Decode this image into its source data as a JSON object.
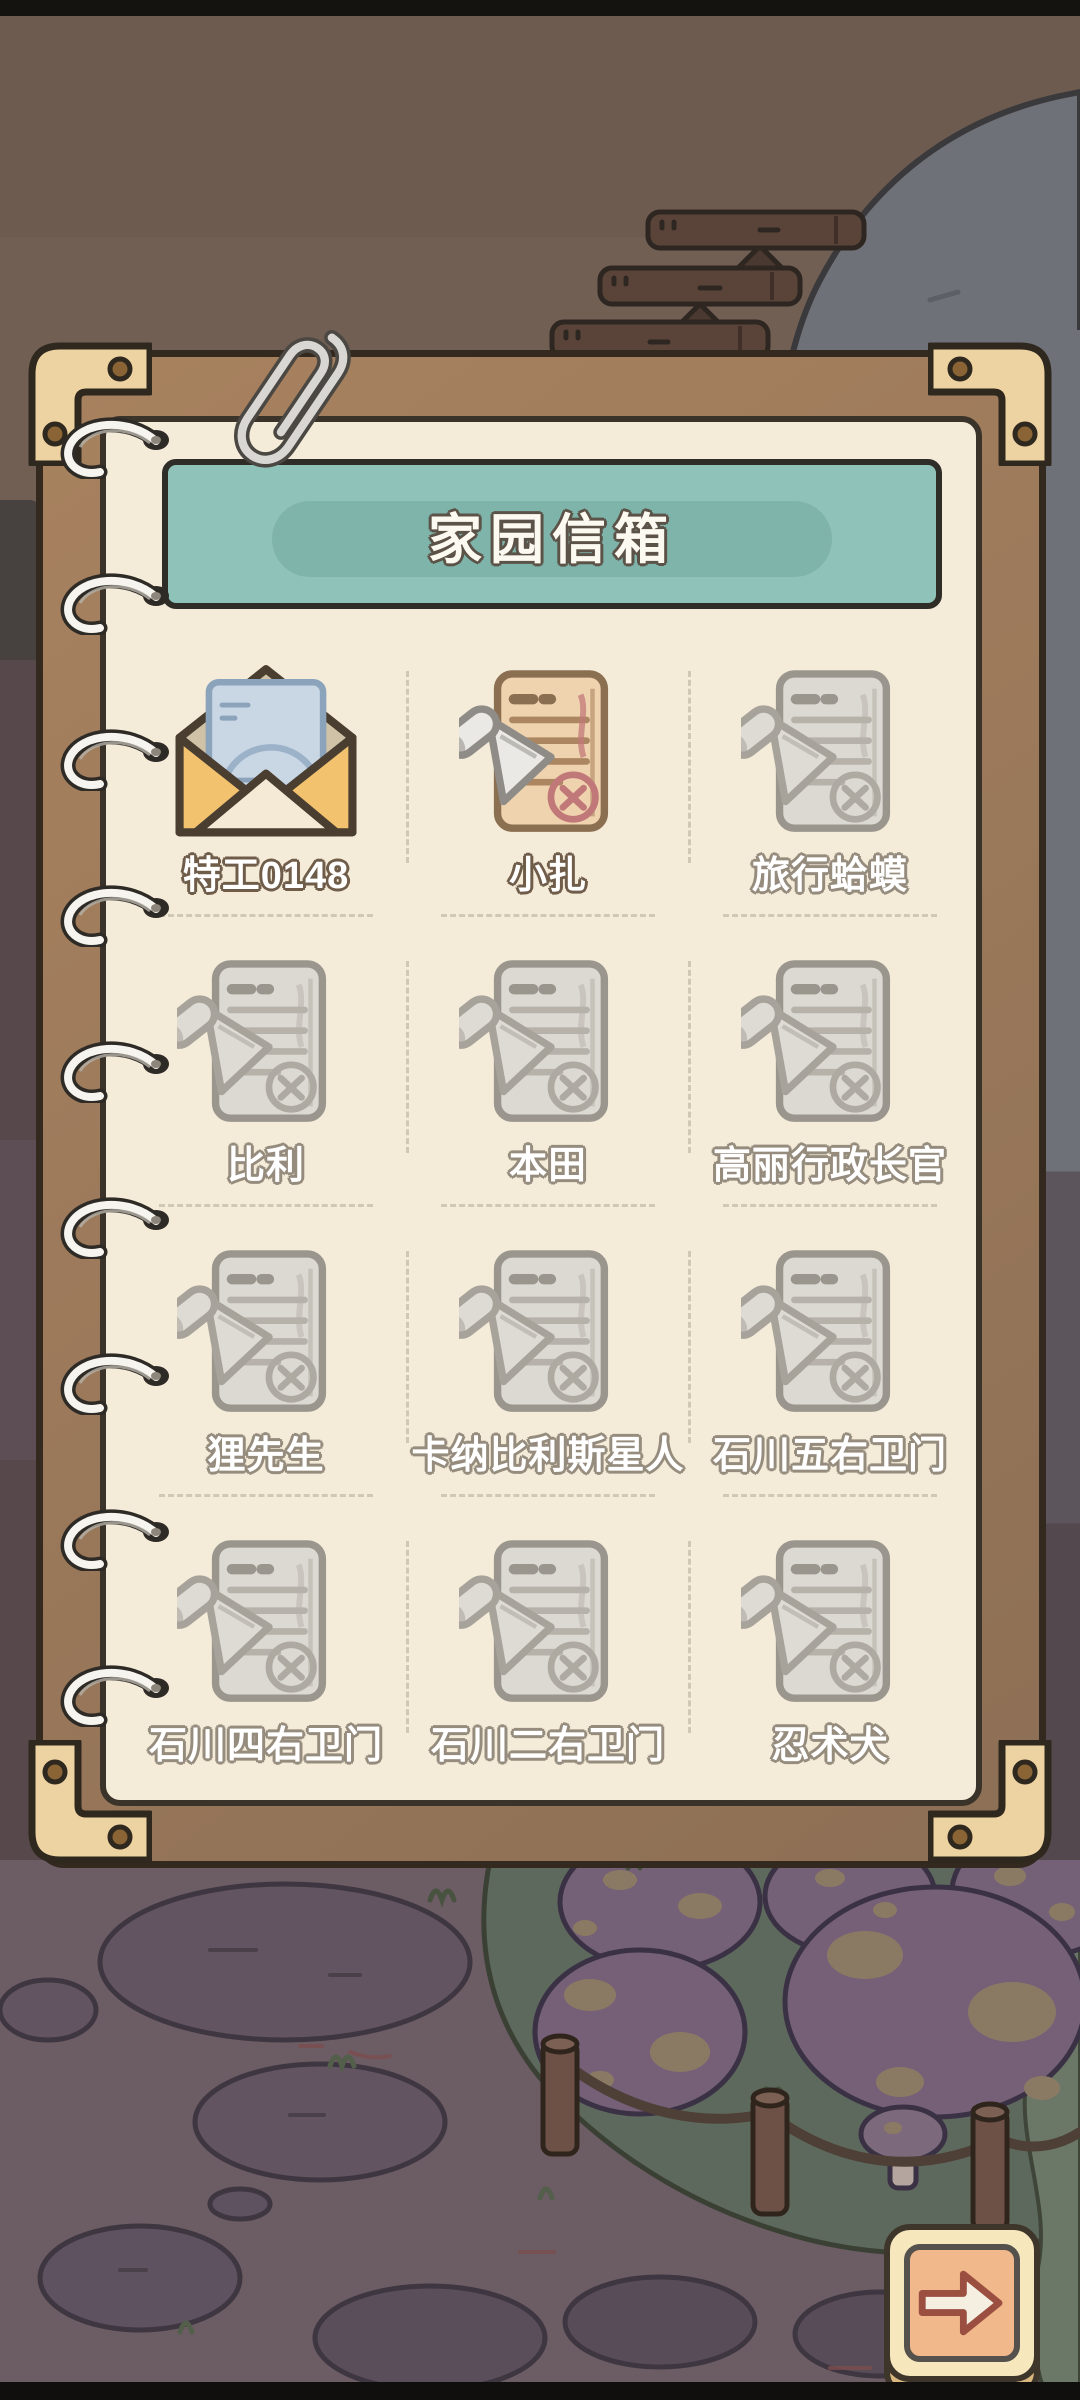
{
  "header": {
    "title": "家园信箱"
  },
  "mailbox": {
    "items": [
      {
        "label": "特工0148",
        "icon": "open-envelope-icon",
        "state": "opened"
      },
      {
        "label": "小扎",
        "icon": "unread-letter-icon",
        "state": "new"
      },
      {
        "label": "旅行蛤蟆",
        "icon": "read-letter-icon",
        "state": "read"
      },
      {
        "label": "比利",
        "icon": "read-letter-icon",
        "state": "read"
      },
      {
        "label": "本田",
        "icon": "read-letter-icon",
        "state": "read"
      },
      {
        "label": "高丽行政长官",
        "icon": "read-letter-icon",
        "state": "read"
      },
      {
        "label": "狸先生",
        "icon": "read-letter-icon",
        "state": "read"
      },
      {
        "label": "卡纳比利斯星人",
        "icon": "read-letter-icon",
        "state": "read"
      },
      {
        "label": "石川五右卫门",
        "icon": "read-letter-icon",
        "state": "read"
      },
      {
        "label": "石川四右卫门",
        "icon": "read-letter-icon",
        "state": "read"
      },
      {
        "label": "石川二右卫门",
        "icon": "read-letter-icon",
        "state": "read"
      },
      {
        "label": "忍术犬",
        "icon": "read-letter-icon",
        "state": "read"
      }
    ]
  },
  "pagination": {
    "next_button": "next-page-arrow"
  },
  "colors": {
    "banner_teal": "#8fc2b9",
    "paper_cream": "#f4ecd9",
    "frame_wood": "#9d7a5e",
    "corner_brass": "#eed3a2",
    "button_face": "#f6e8bc",
    "button_inner": "#f1b88b",
    "arrow_outline": "#9b4f40"
  }
}
